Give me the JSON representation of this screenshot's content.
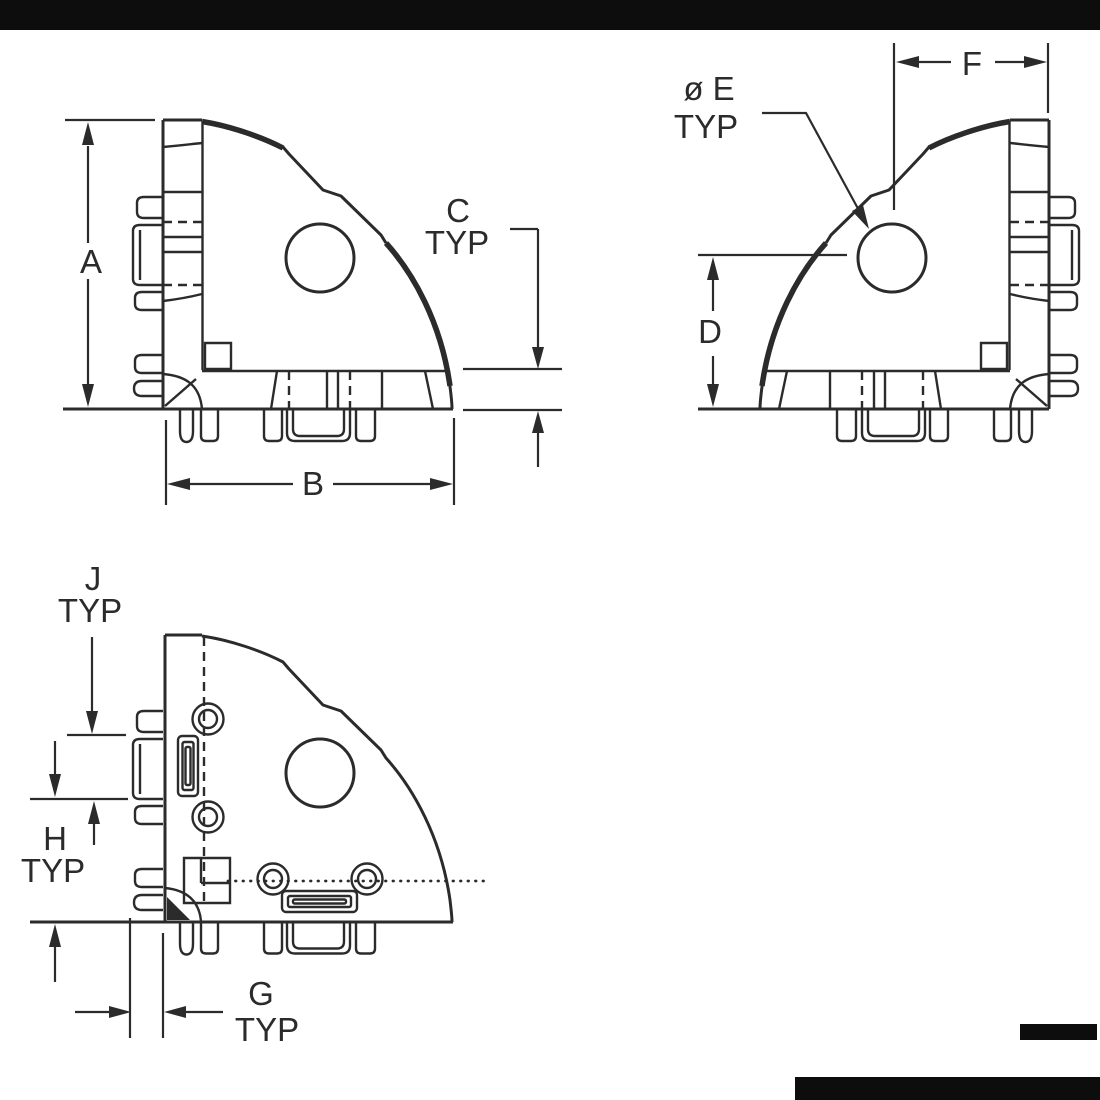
{
  "drawing": {
    "background": "#ffffff",
    "line_color": "#2b2b2b",
    "border_color": "#0d0d0d",
    "type": "dimensioned engineering drawing, corner bracket, three views"
  },
  "labels": {
    "a": "A",
    "b": "B",
    "c": "C",
    "c_typ": "TYP",
    "d": "D",
    "e_dia": "ø E",
    "e_typ": "TYP",
    "f": "F",
    "g": "G",
    "g_typ": "TYP",
    "h": "H",
    "h_typ": "TYP",
    "j": "J",
    "j_typ": "TYP"
  }
}
